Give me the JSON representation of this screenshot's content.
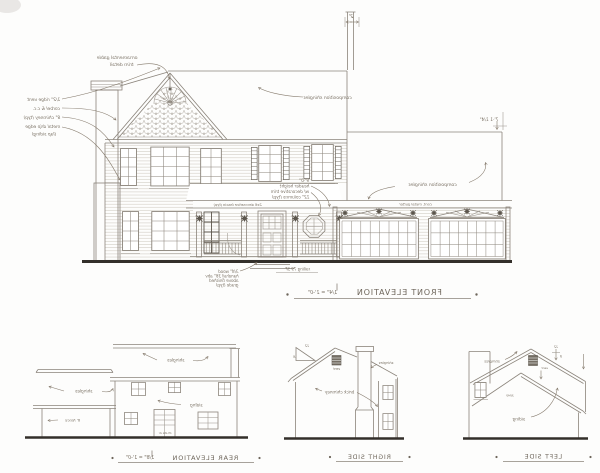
{
  "front": {
    "title": "FRONT ELEVATION",
    "scale": "1/4\" = 1'-0\"",
    "ann": {
      "gable1": "ornamental gable",
      "gable2": "trim detail",
      "co1": "1/2\" ridge vent",
      "co2": "corbel & c.c.",
      "co3": "8\" chimney (typ)",
      "co4": "metal drip edge",
      "co5": "(lap siding)",
      "shingles_upper": "composition shingles",
      "shingles_lower": "composition shingles",
      "gutter": "cont. metal gutter",
      "fascia_note": "2x6 decorative fascia (typ)",
      "flue_dim": "2'",
      "eave_dim": "7'-1 1/4\"",
      "porch1": "9'-0\"",
      "porch2": "header height",
      "porch3": "w/ decorative trim",
      "porch4": "12\" columns (typ)",
      "deck1": "3/4\" wood",
      "deck2": "handrail 36\" abv",
      "deck3": "above finished",
      "deck4": "grade (typ)",
      "porch_area": "railing 79 SF"
    }
  },
  "rear": {
    "title": "REAR ELEVATION",
    "scale": "1/8\" = 1'-0\"",
    "ann": {
      "shingles_l": "shingles",
      "shingles_r": "shingles",
      "siding": "siding",
      "fence": "6' fence",
      "door": "15-lite dr"
    }
  },
  "right": {
    "title": "RIGHT SIDE",
    "ann": {
      "pitch_run": "12",
      "pitch_rise": "8",
      "vent": "vent",
      "shingles": "shingles",
      "chimney": "brick chimney"
    }
  },
  "left": {
    "title": "LEFT SIDE",
    "ann": {
      "pitch_run": "12",
      "pitch_rise": "8",
      "vent": "vent",
      "shingles": "shingles",
      "siding": "siding",
      "win": "3040"
    }
  }
}
